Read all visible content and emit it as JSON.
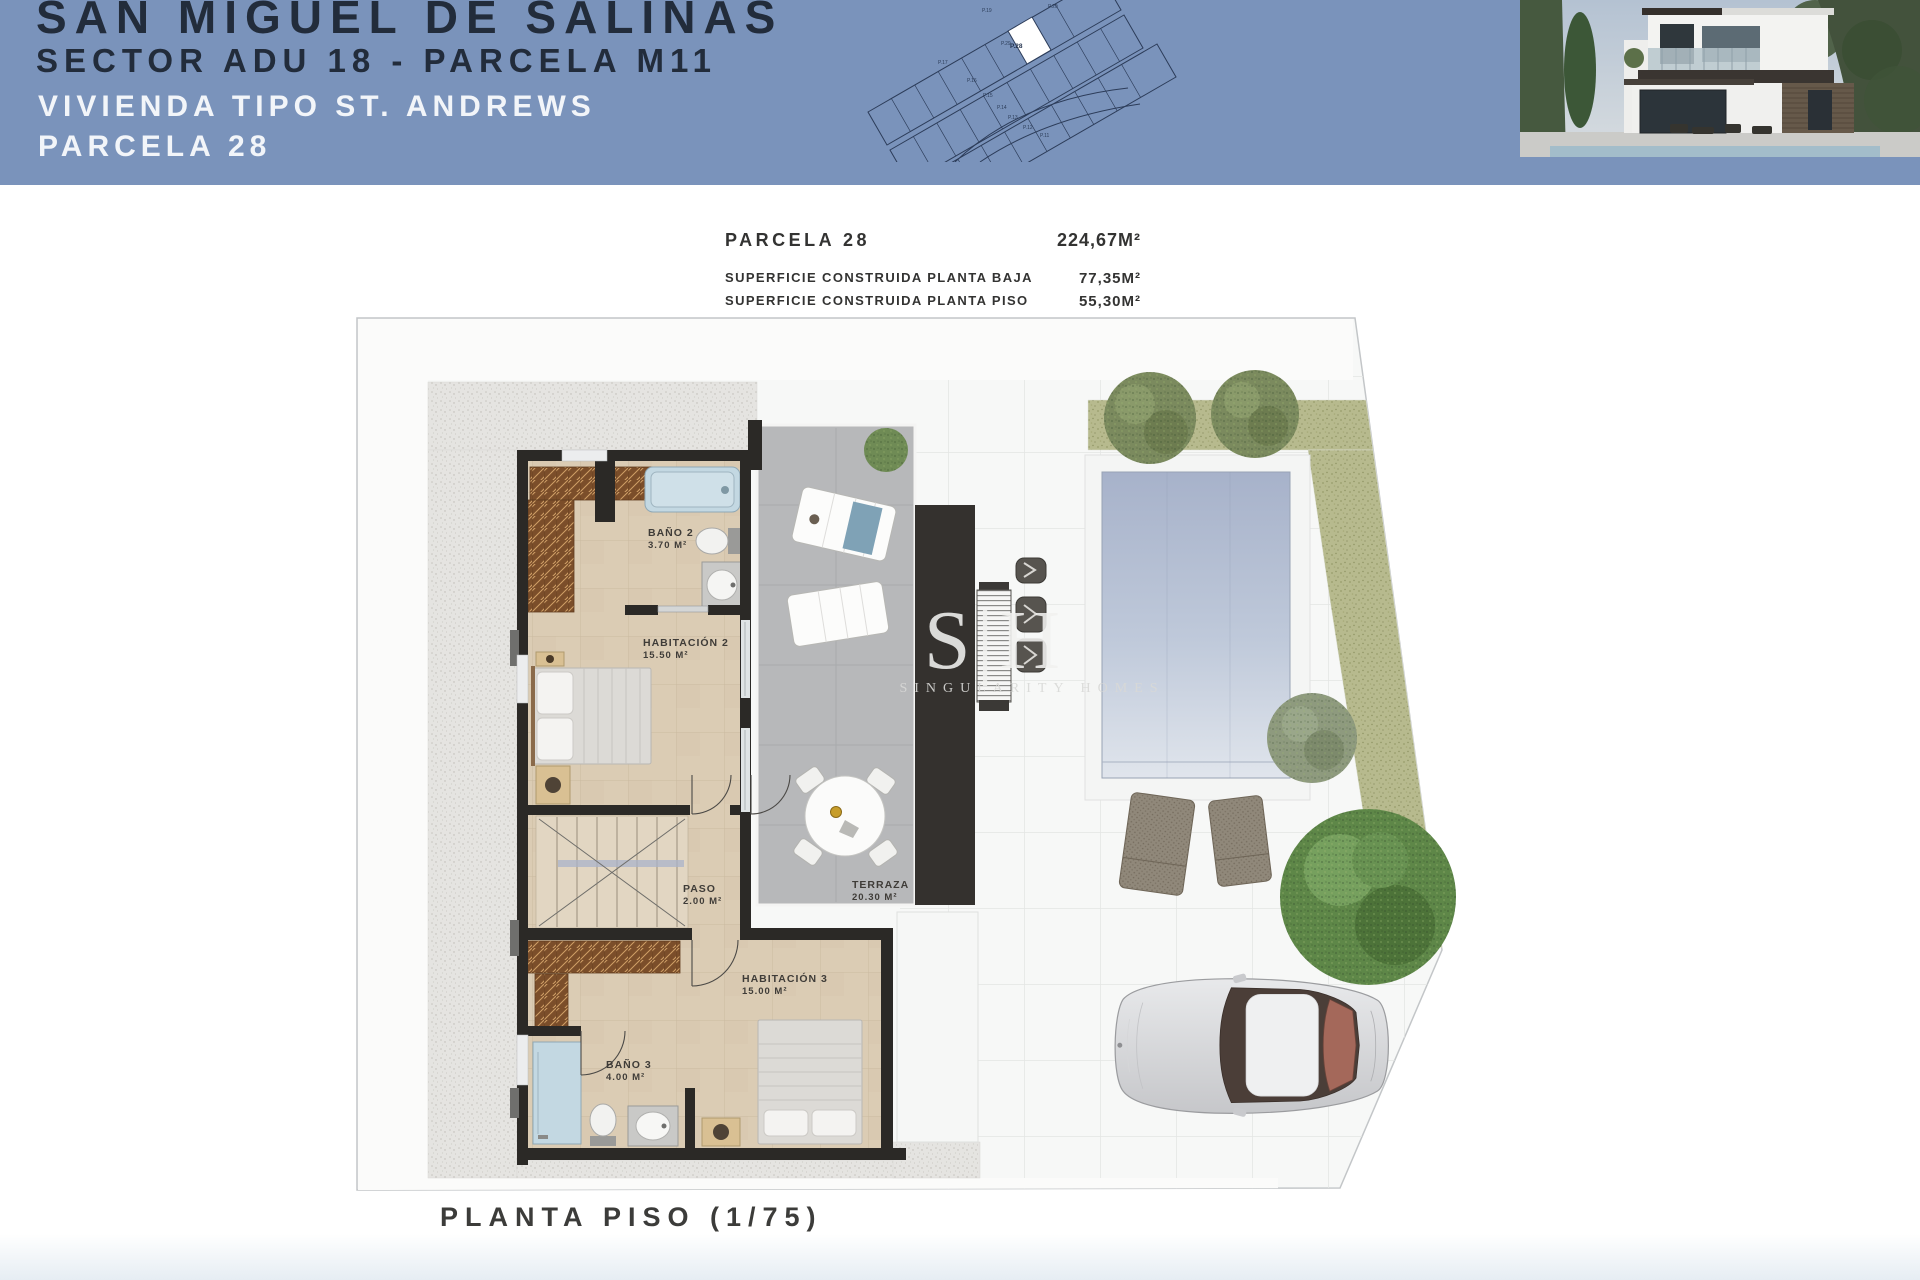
{
  "header": {
    "title_line1": "SAN MIGUEL DE SALINAS",
    "title_line2": "SECTOR ADU 18 - PARCELA M11",
    "subtitle_line1": "VIVIENDA TIPO ST. ANDREWS",
    "subtitle_line2": "PARCELA 28",
    "site_plan": {
      "highlighted_parcel": "P.28",
      "parcel_labels": [
        "P.19",
        "P.20",
        "P.29",
        "P.17",
        "P.16",
        "P.15",
        "P.14",
        "P.13",
        "P.12",
        "P.11"
      ]
    }
  },
  "summary": {
    "rows": [
      {
        "label": "PARCELA 28",
        "value": "224,67M²"
      },
      {
        "label": "SUPERFICIE CONSTRUIDA PLANTA BAJA",
        "value": "77,35M²"
      },
      {
        "label": "SUPERFICIE CONSTRUIDA PLANTA PISO",
        "value": "55,30M²"
      },
      {
        "label": "SUPERFICIE CONSTRUIDA TOTAL",
        "value": "132,65M²"
      }
    ]
  },
  "plan": {
    "caption": "PLANTA PISO (1/75)",
    "rooms": [
      {
        "name": "BAÑO 2",
        "area": "3.70 M²"
      },
      {
        "name": "HABITACIÓN 2",
        "area": "15.50 M²"
      },
      {
        "name": "PASO",
        "area": "2.00 M²"
      },
      {
        "name": "TERRAZA",
        "area": "20.30 M²"
      },
      {
        "name": "HABITACIÓN 3",
        "area": "15.00 M²"
      },
      {
        "name": "BAÑO 3",
        "area": "4.00 M²"
      }
    ]
  },
  "watermark": {
    "monogram": "S|H",
    "brand": "SINGULARITY HOMES"
  },
  "colors": {
    "header_blue": "#7a93bb",
    "title_navy": "#222c3b",
    "header_text_white": "#f2f5f9",
    "gravel": "#e5e4e1",
    "grass": "#b7ba8e",
    "terrace_gray": "#b7b8ba",
    "floor_beige": "#dbccb4",
    "wall_dark": "#2b2926",
    "pool_blue": "#a7b2ca",
    "wood_brown": "#7b4e2a",
    "bath_blue": "#c3d8e2"
  }
}
